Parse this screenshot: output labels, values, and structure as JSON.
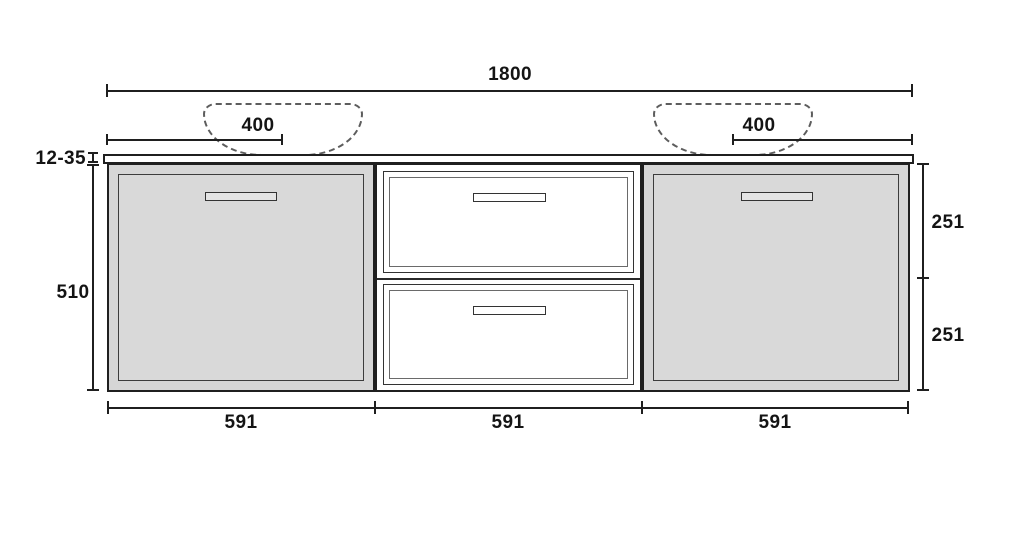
{
  "diagram": {
    "type": "furniture-dimension-drawing",
    "subject": "wall-hung double-basin vanity cabinet, front elevation",
    "labels": {
      "overall_width": "1800",
      "sink_left_offset": "400",
      "sink_right_offset": "400",
      "countertop_thickness": "12-35",
      "cabinet_height": "510",
      "right_upper_height": "251",
      "right_lower_height": "251",
      "left_section_width": "591",
      "middle_section_width": "591",
      "right_section_width": "591"
    },
    "colors": {
      "background": "#ffffff",
      "line": "#1f1f1f",
      "door_fill": "#d6d6d6",
      "door_panel_fill": "#d9d9d9",
      "drawer_fill": "#ffffff",
      "countertop_fill": "#ffffff",
      "sink_dash": "#5d5d5d",
      "text": "#141414"
    }
  }
}
